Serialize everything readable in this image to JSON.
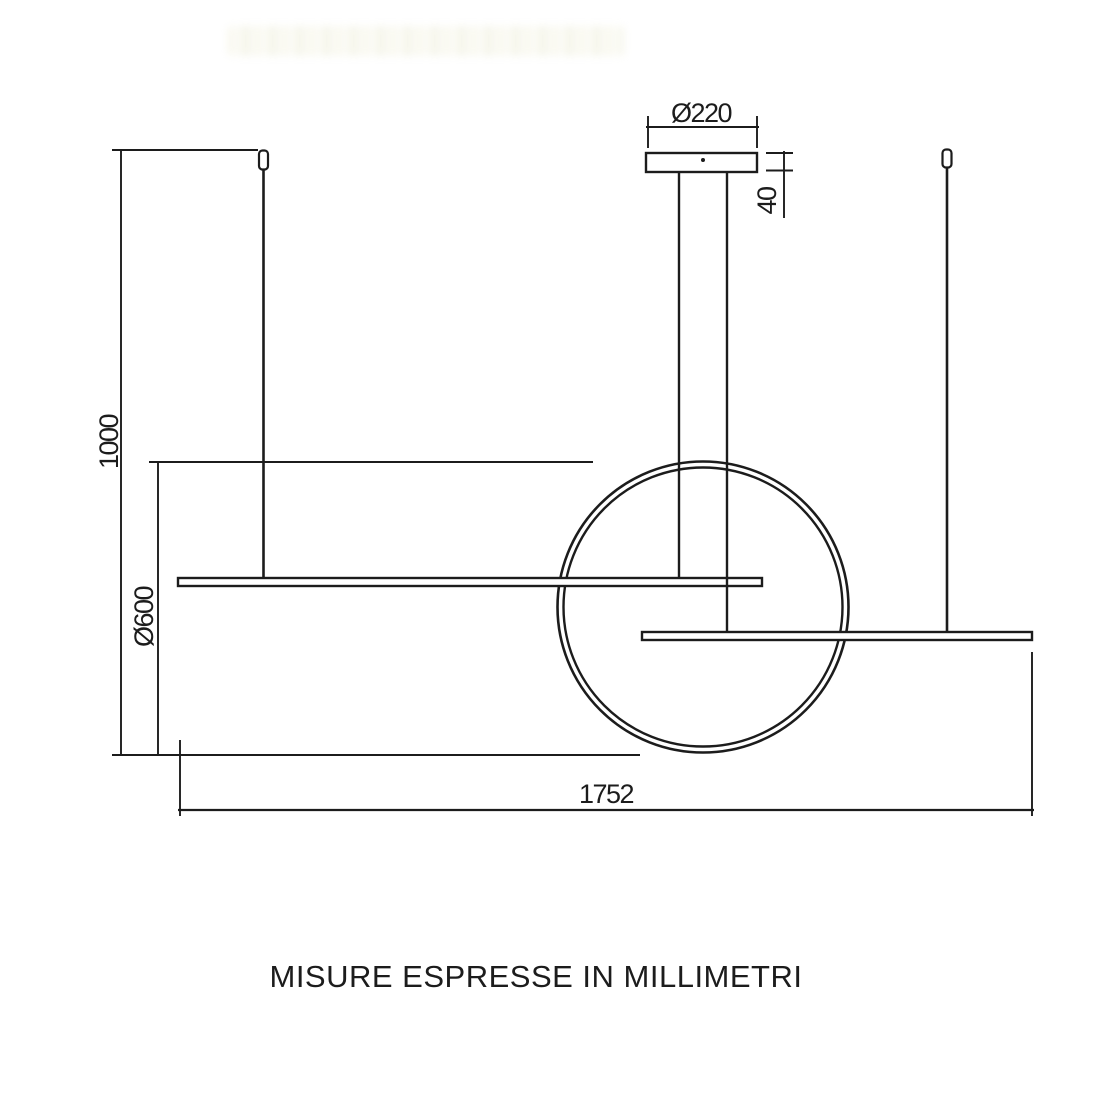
{
  "meta": {
    "caption": "MISURE ESPRESSE IN MILLIMETRI",
    "drawing_type": "pendant-lamp-dimension-diagram"
  },
  "colors": {
    "background": "#ffffff",
    "line": "#1c1c1c",
    "watermark_tint": "#e8e6c4"
  },
  "dimensions": {
    "canopy_diameter": {
      "label": "Ø220",
      "value_mm": 220
    },
    "canopy_height": {
      "label": "40",
      "value_mm": 40
    },
    "suspension_drop": {
      "label": "1000",
      "value_mm": 1000
    },
    "ring_diameter": {
      "label": "Ø600",
      "value_mm": 600
    },
    "total_width": {
      "label": "1752",
      "value_mm": 1752
    }
  }
}
